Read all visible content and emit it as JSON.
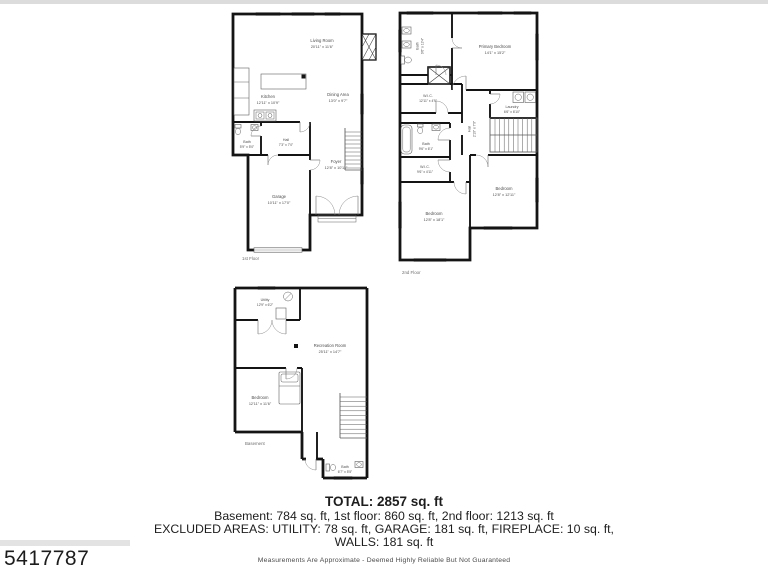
{
  "page": {
    "mls_number": "5417787",
    "disclaimer": "Measurements Are Approximate - Deemed Highly Reliable But Not Guaranteed",
    "colors": {
      "walls": "#141414",
      "labels": "#4d4d4d",
      "background": "#ffffff",
      "top_strip": "#dcdcdc"
    }
  },
  "summary": {
    "total": "TOTAL: 2857 sq. ft",
    "floors_line": "Basement: 784 sq. ft, 1st floor: 860 sq. ft, 2nd floor: 1213 sq. ft",
    "excluded_line": "EXCLUDED AREAS: UTILITY: 78 sq. ft, GARAGE: 181 sq. ft, FIREPLACE: 10 sq. ft,",
    "walls_line": "WALLS: 181 sq. ft"
  },
  "first_floor": {
    "label": "1st Floor",
    "living": {
      "name": "Living Room",
      "dims": "20'11\" x 11'6\""
    },
    "kitchen": {
      "name": "Kitchen",
      "dims": "12'11\" x 10'9\""
    },
    "dining": {
      "name": "Dining Area",
      "dims": "13'0\" x 9'7\""
    },
    "bath": {
      "name": "Bath",
      "dims": "5'9\" x 5'0\""
    },
    "hall": {
      "name": "Hall",
      "dims": "7'3\" x 7'0\""
    },
    "garage": {
      "name": "Garage",
      "dims": "10'11\" x 17'0\""
    },
    "foyer": {
      "name": "Foyer",
      "dims": "12'8\" x 10'11\""
    }
  },
  "second_floor": {
    "label": "2nd Floor",
    "bath_top": {
      "name": "Bath",
      "dims": "9'6\" x 13'4\""
    },
    "primary": {
      "name": "Primary Bedroom",
      "dims": "14'1\" x 15'2\""
    },
    "wic_upper": {
      "name": "W.I.C.",
      "dims": "12'11\" x 4'9\""
    },
    "laundry": {
      "name": "Laundry",
      "dims": "6'6\" x 6'10\""
    },
    "hall": {
      "name": "Hall",
      "dims": "2'10\" x 7'0\""
    },
    "bath_mid": {
      "name": "Bath",
      "dims": "9'6\" x 6'1\""
    },
    "wic_lower": {
      "name": "W.I.C.",
      "dims": "9'6\" x 4'11\""
    },
    "bedroom_left": {
      "name": "Bedroom",
      "dims": "12'8\" x 18'1\""
    },
    "bedroom_right": {
      "name": "Bedroom",
      "dims": "12'8\" x 12'11\""
    }
  },
  "basement": {
    "label": "Basement",
    "utility": {
      "name": "Utility",
      "dims": "12'9\" x 6'2\""
    },
    "recreation": {
      "name": "Recreation Room",
      "dims": "25'11\" x 14'7\""
    },
    "bedroom": {
      "name": "Bedroom",
      "dims": "12'11\" x 11'6\""
    },
    "bath": {
      "name": "Bath",
      "dims": "6'7\" x 5'5\""
    }
  }
}
